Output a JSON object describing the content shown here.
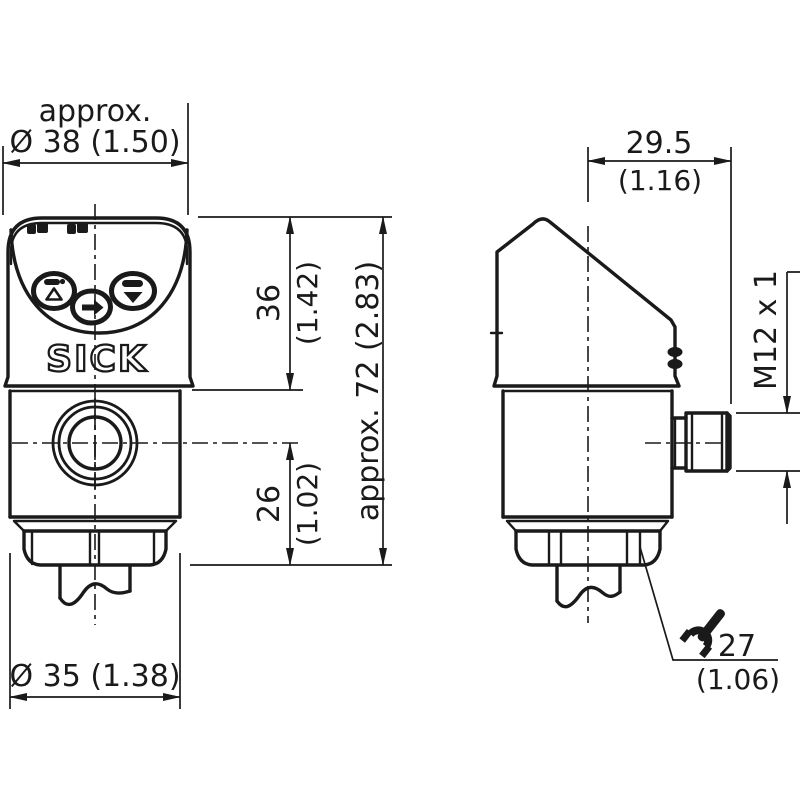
{
  "colors": {
    "line": "#1a1a1a",
    "background": "#ffffff"
  },
  "logo": "SICK",
  "icons": {
    "up_button": "bar-and-up-triangle",
    "enter_button": "right-arrow",
    "down_button": "bar-and-down-triangle",
    "wrench": "open-end-wrench",
    "led": "status-led-pair"
  },
  "dimensions": {
    "front": {
      "width_top": {
        "prefix": "approx.",
        "label": "Ø 38 (1.50)"
      },
      "height_upper": {
        "mm": "36",
        "inch": "(1.42)"
      },
      "height_lower": {
        "mm": "26",
        "inch": "(1.02)"
      },
      "height_total": {
        "label": "approx. 72 (2.83)"
      },
      "width_bottom": {
        "label": "Ø 35 (1.38)"
      }
    },
    "side": {
      "depth": {
        "mm": "29.5",
        "inch": "(1.16)"
      },
      "connector_thread": {
        "label": "M12 x 1"
      },
      "wrench_size": {
        "mm": "27",
        "inch": "(1.06)"
      }
    }
  }
}
